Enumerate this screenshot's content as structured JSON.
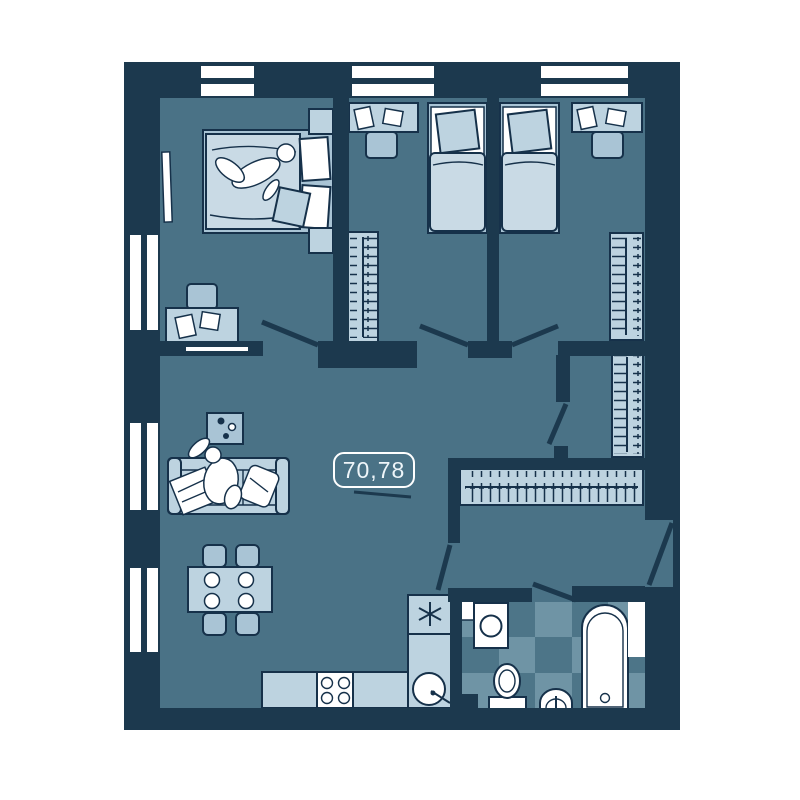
{
  "floor_plan": {
    "area_label": "70,78",
    "colors": {
      "page_bg": "#ffffff",
      "wall": "#1c394e",
      "outline": "#16314a",
      "floor": "#4a7286",
      "furn_light": "#bdd3e0",
      "furn_mid": "#a9c4d5",
      "furn_soft": "#c9dae5",
      "tile_base": "#4d7588",
      "tile_light": "#6f94a5",
      "paper": "#ffffff",
      "label_text": "#eef5f9"
    }
  }
}
